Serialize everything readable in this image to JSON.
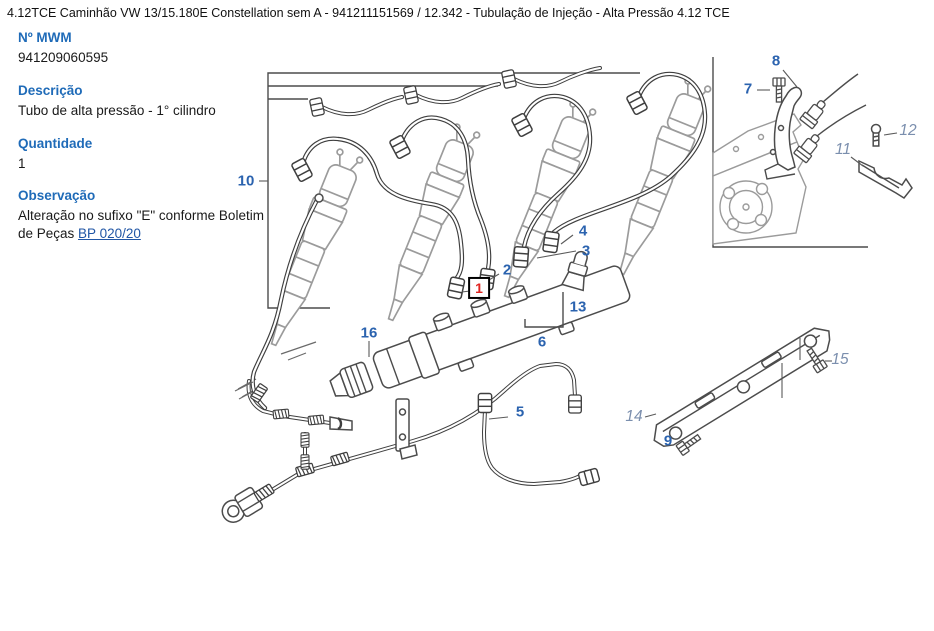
{
  "header": {
    "title": "4.12TCE Caminhão VW 13/15.180E Constellation sem A - 941211151569  /  12.342 - Tubulação de Injeção - Alta Pressão 4.12 TCE"
  },
  "panel": {
    "mwm_label": "Nº MWM",
    "mwm_value": "941209060595",
    "desc_label": "Descrição",
    "desc_value": "Tubo de alta pressão - 1° cilindro",
    "qty_label": "Quantidade",
    "qty_value": "1",
    "obs_label": "Observação",
    "obs_text": "Alteração no sufixo \"E\" conforme Boletim de Peças ",
    "obs_link_label": "BP 020/20"
  },
  "diagram": {
    "selected_part": "1",
    "callouts": [
      {
        "label": "10",
        "x": 246,
        "y": 181,
        "style": "primary"
      },
      {
        "label": "16",
        "x": 369,
        "y": 333,
        "style": "primary"
      },
      {
        "label": "1",
        "x": 479,
        "y": 288,
        "style": "selected"
      },
      {
        "label": "2",
        "x": 507,
        "y": 270,
        "style": "primary"
      },
      {
        "label": "3",
        "x": 586,
        "y": 251,
        "style": "primary"
      },
      {
        "label": "4",
        "x": 583,
        "y": 231,
        "style": "primary"
      },
      {
        "label": "5",
        "x": 520,
        "y": 412,
        "style": "primary"
      },
      {
        "label": "6",
        "x": 542,
        "y": 342,
        "style": "primary"
      },
      {
        "label": "13",
        "x": 578,
        "y": 307,
        "style": "primary"
      },
      {
        "label": "7",
        "x": 748,
        "y": 89,
        "style": "primary"
      },
      {
        "label": "8",
        "x": 776,
        "y": 61,
        "style": "primary"
      },
      {
        "label": "9",
        "x": 668,
        "y": 441,
        "style": "primary"
      },
      {
        "label": "11",
        "x": 843,
        "y": 150,
        "style": "secondary"
      },
      {
        "label": "12",
        "x": 908,
        "y": 131,
        "style": "secondary"
      },
      {
        "label": "14",
        "x": 634,
        "y": 417,
        "style": "secondary"
      },
      {
        "label": "15",
        "x": 840,
        "y": 360,
        "style": "secondary"
      }
    ],
    "colors": {
      "callout_primary": "#2b63af",
      "callout_secondary": "#7b8fae",
      "selected_text": "#e02420",
      "selected_border": "#000000",
      "panel_label": "#1f6bb8",
      "link": "#2156a5",
      "line_art": "#4c4c4c"
    }
  }
}
